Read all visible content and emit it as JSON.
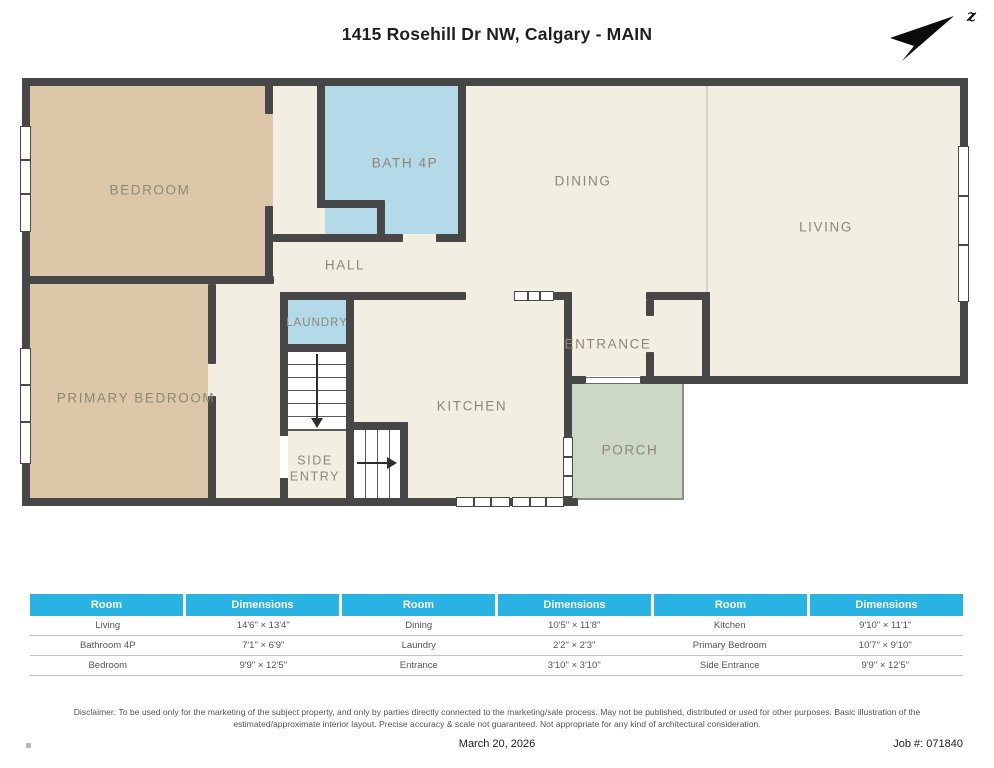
{
  "header": {
    "title": "1415 Rosehill Dr NW, Calgary - MAIN",
    "compass_label": "z"
  },
  "plan": {
    "rooms": {
      "bedroom": "BEDROOM",
      "bath": "BATH 4P",
      "dining": "DINING",
      "living": "LIVING",
      "hall": "HALL",
      "laundry": "LAUNDRY",
      "primary_bedroom": "PRIMARY BEDROOM",
      "entrance": "ENTRANCE",
      "kitchen": "KITCHEN",
      "side_entry": "SIDE ENTRY",
      "porch": "PORCH"
    }
  },
  "table": {
    "headers": [
      "Room",
      "Dimensions",
      "Room",
      "Dimensions",
      "Room",
      "Dimensions"
    ],
    "rows": [
      [
        "Living",
        "14'6\" × 13'4\"",
        "Dining",
        "10'5\" × 11'8\"",
        "Kitchen",
        "9'10\" × 11'1\""
      ],
      [
        "Bathroom 4P",
        "7'1\" × 6'9\"",
        "Laundry",
        "2'2\" × 2'3\"",
        "Primary Bedroom",
        "10'7\" × 9'10\""
      ],
      [
        "Bedroom",
        "9'9\" × 12'5\"",
        "Entrance",
        "3'10\" × 3'10\"",
        "Side Entrance",
        "9'9\" × 12'5\""
      ]
    ]
  },
  "footer": {
    "disclaimer": "Disclaimer: To be used only for the marketing of the subject property, and only by parties directly connected to the marketing/sale process. May not be published, distributed or used for other purposes. Basic illustration of the estimated/approximate interior layout. Precise accuracy & scale not guaranteed. Not appropriate for any kind of architectural consideration.",
    "date": "March 20, 2026",
    "job_number": "Job #: 071840"
  },
  "colors": {
    "accent": "#29b3e3",
    "wall": "#474747",
    "room_tan": "#dcc8a8",
    "room_blue": "#b4d9e8",
    "room_green": "#ccd8c5",
    "room_cream": "#f3eee2"
  }
}
